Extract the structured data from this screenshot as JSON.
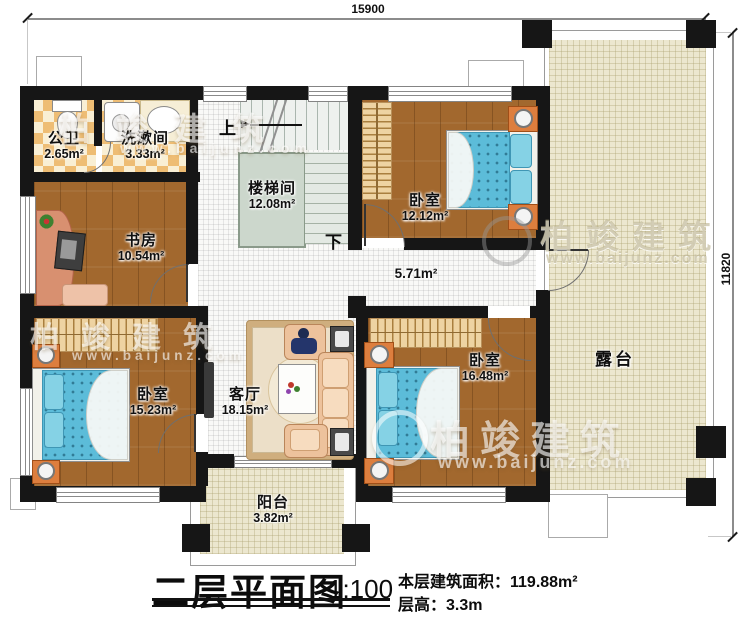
{
  "title": {
    "plan_name": "二层平面图",
    "scale": "1:100",
    "area_line": "本层建筑面积：119.88m²",
    "height_line": "层高：3.3m"
  },
  "dimensions": {
    "top_width": "15900",
    "right_height": "11820"
  },
  "rooms": [
    {
      "id": "bath",
      "name": "公卫",
      "area": "2.65m²"
    },
    {
      "id": "washroom",
      "name": "洗漱间",
      "area": "3.33m²"
    },
    {
      "id": "study",
      "name": "书房",
      "area": "10.54m²"
    },
    {
      "id": "stairwell",
      "name": "楼梯间",
      "area": "12.08m²"
    },
    {
      "id": "bedroom-tr",
      "name": "卧室",
      "area": "12.12m²"
    },
    {
      "id": "corridor",
      "name": "",
      "area": "5.71m²"
    },
    {
      "id": "bedroom-bl",
      "name": "卧室",
      "area": "15.23m²"
    },
    {
      "id": "living",
      "name": "客厅",
      "area": "18.15m²"
    },
    {
      "id": "bedroom-br",
      "name": "卧室",
      "area": "16.48m²"
    },
    {
      "id": "balcony",
      "name": "阳台",
      "area": "3.82m²"
    },
    {
      "id": "terrace",
      "name": "露台",
      "area": ""
    }
  ],
  "stairs": {
    "up": "上",
    "down": "下"
  },
  "watermark": {
    "brand": "柏竣建筑",
    "site": "www.baijunz.com"
  },
  "colors": {
    "wall": "#161616",
    "wood_floor": "#a2682e",
    "tile_orange": "#eebd74",
    "tile_cream": "#f9efd4",
    "indoor_white": "#f9f9f7",
    "outdoor_beige": "#ece7cf",
    "stair_core": "#ccd7cc",
    "bed_blue": "#5cbcd9",
    "nightstand_orange": "#dd7e3e",
    "wardrobe_tan": "#eed3a2",
    "sofa_peach": "#edc29c"
  }
}
